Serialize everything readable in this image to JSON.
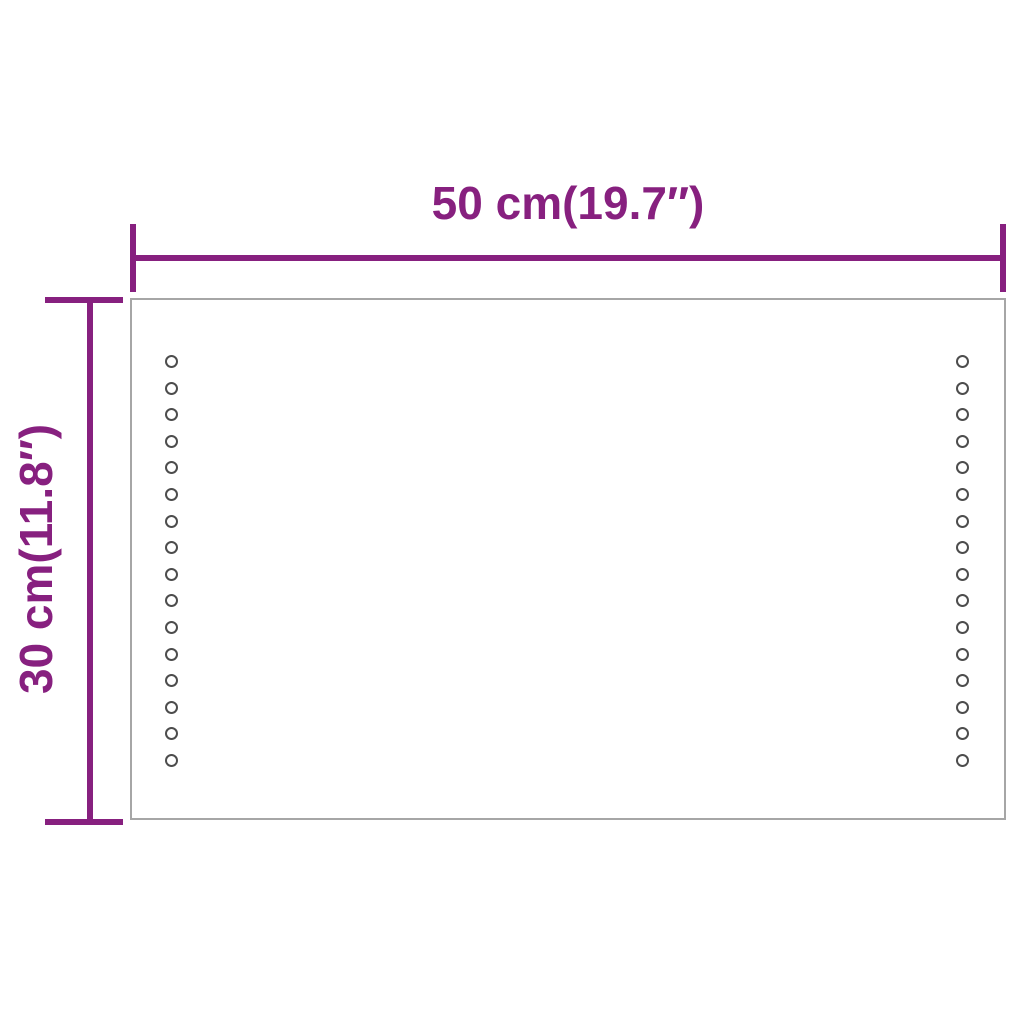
{
  "diagram": {
    "type": "product-dimension-diagram",
    "subject": "led-mirror",
    "width_label": "50 cm(19.7″)",
    "height_label": "30 cm(11.8″)"
  },
  "mirror": {
    "led_dots_per_column": 16,
    "led_columns": [
      "left",
      "right"
    ]
  },
  "colors": {
    "dimension_accent": "#87207F",
    "mirror_border": "#A6A6A6",
    "led_dot_outline": "#4D4D4D",
    "background": "#FFFFFF"
  }
}
